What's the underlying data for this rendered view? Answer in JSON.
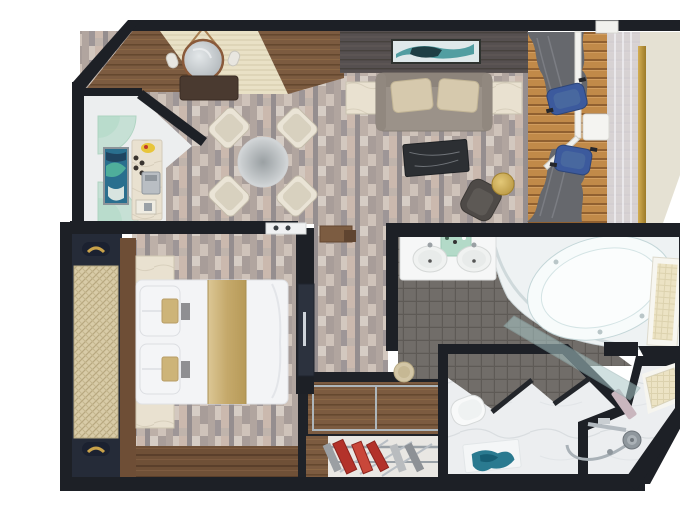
{
  "scene": {
    "description": "3D rendered top-down floor plan of a cruise-ship suite with entry, pantry bar, living-dining room, balcony, bedroom, walk-in closet, bathroom with corner tub, separate toilet room and shower room",
    "type": "floor-plan"
  },
  "palette": {
    "wall": "#1d2026",
    "parquet": "#c6bab2",
    "wood_entry": "#7c5b40",
    "wood_dark": "#565050",
    "wood_floor": "#6f5037",
    "deck": "#c18a49",
    "rug": "#e9e1c6",
    "hull": "#e5e1d3",
    "glass_rail": "#d9d8df",
    "gold": "#c9a24a",
    "navy": "#252b38",
    "cane": "#d8cba7",
    "sofa": "#9b9289",
    "pillow": "#d6c9ad",
    "chair_cream": "#eae4d6",
    "blue_chair": "#3c5a9d",
    "curtain": "#66686d",
    "marble": "#eceef0",
    "marble_beige": "#e9e1d0",
    "mosaic": "#716d69",
    "white_fixture": "#f6f7f7",
    "glass_green": "#a8d6c0",
    "teal": "#2a7a90",
    "tub": "#eef2f3",
    "gold_runner": "#cdb478",
    "red_garment": "#b3322a",
    "armchair": "#4e4a47",
    "coffee_table": "#2c2f33",
    "frost": "#ece3c4"
  },
  "rooms": [
    {
      "name": "entry",
      "features": [
        "striped cream runner rug",
        "round mirror with hanging strap",
        "two wall sconces",
        "dark wood console",
        "wood plank corner floor"
      ]
    },
    {
      "name": "pantry-bar",
      "features": [
        "green glass quarter shelves",
        "framed abstract artwork",
        "marble bar counter",
        "espresso machine",
        "cups",
        "fruit bowl"
      ]
    },
    {
      "name": "living-dining",
      "features": [
        "round table with four cream chairs",
        "media wall with teal artwork",
        "sofa with two pillows",
        "two marble side tables",
        "dark marble coffee table",
        "grey armchair",
        "gold round side table",
        "white display ledge",
        "wood wall shelf"
      ]
    },
    {
      "name": "balcony",
      "features": [
        "teak deck planks",
        "two blue deck chairs",
        "white deck table",
        "grey curtains",
        "sliding glass door",
        "glass balustrade",
        "gold handrail post",
        "hull overhang"
      ]
    },
    {
      "name": "bedroom",
      "features": [
        "double bed with gold runner",
        "two pillows with gold accents",
        "two marble nightstands",
        "wood headboard panel",
        "cane wardrobe doors with gold handles",
        "wood plank floor strip",
        "dark sliding door"
      ]
    },
    {
      "name": "walk-in-closet",
      "features": [
        "wood floor panels with metal trim",
        "clothes rails",
        "red and grey garments"
      ]
    },
    {
      "name": "bathroom",
      "features": [
        "double-sink vanity",
        "green glass shelf",
        "grey mosaic tile floor",
        "corner whirlpool tub",
        "leaning glass partition",
        "frosted window",
        "round stool"
      ]
    },
    {
      "name": "toilet-room",
      "features": [
        "toilet",
        "teal accent rug",
        "marble floor",
        "angled niche walls"
      ]
    },
    {
      "name": "shower-room",
      "features": [
        "handheld shower set",
        "grab bar",
        "frosted window",
        "marble floor",
        "chamfered corner"
      ]
    }
  ]
}
